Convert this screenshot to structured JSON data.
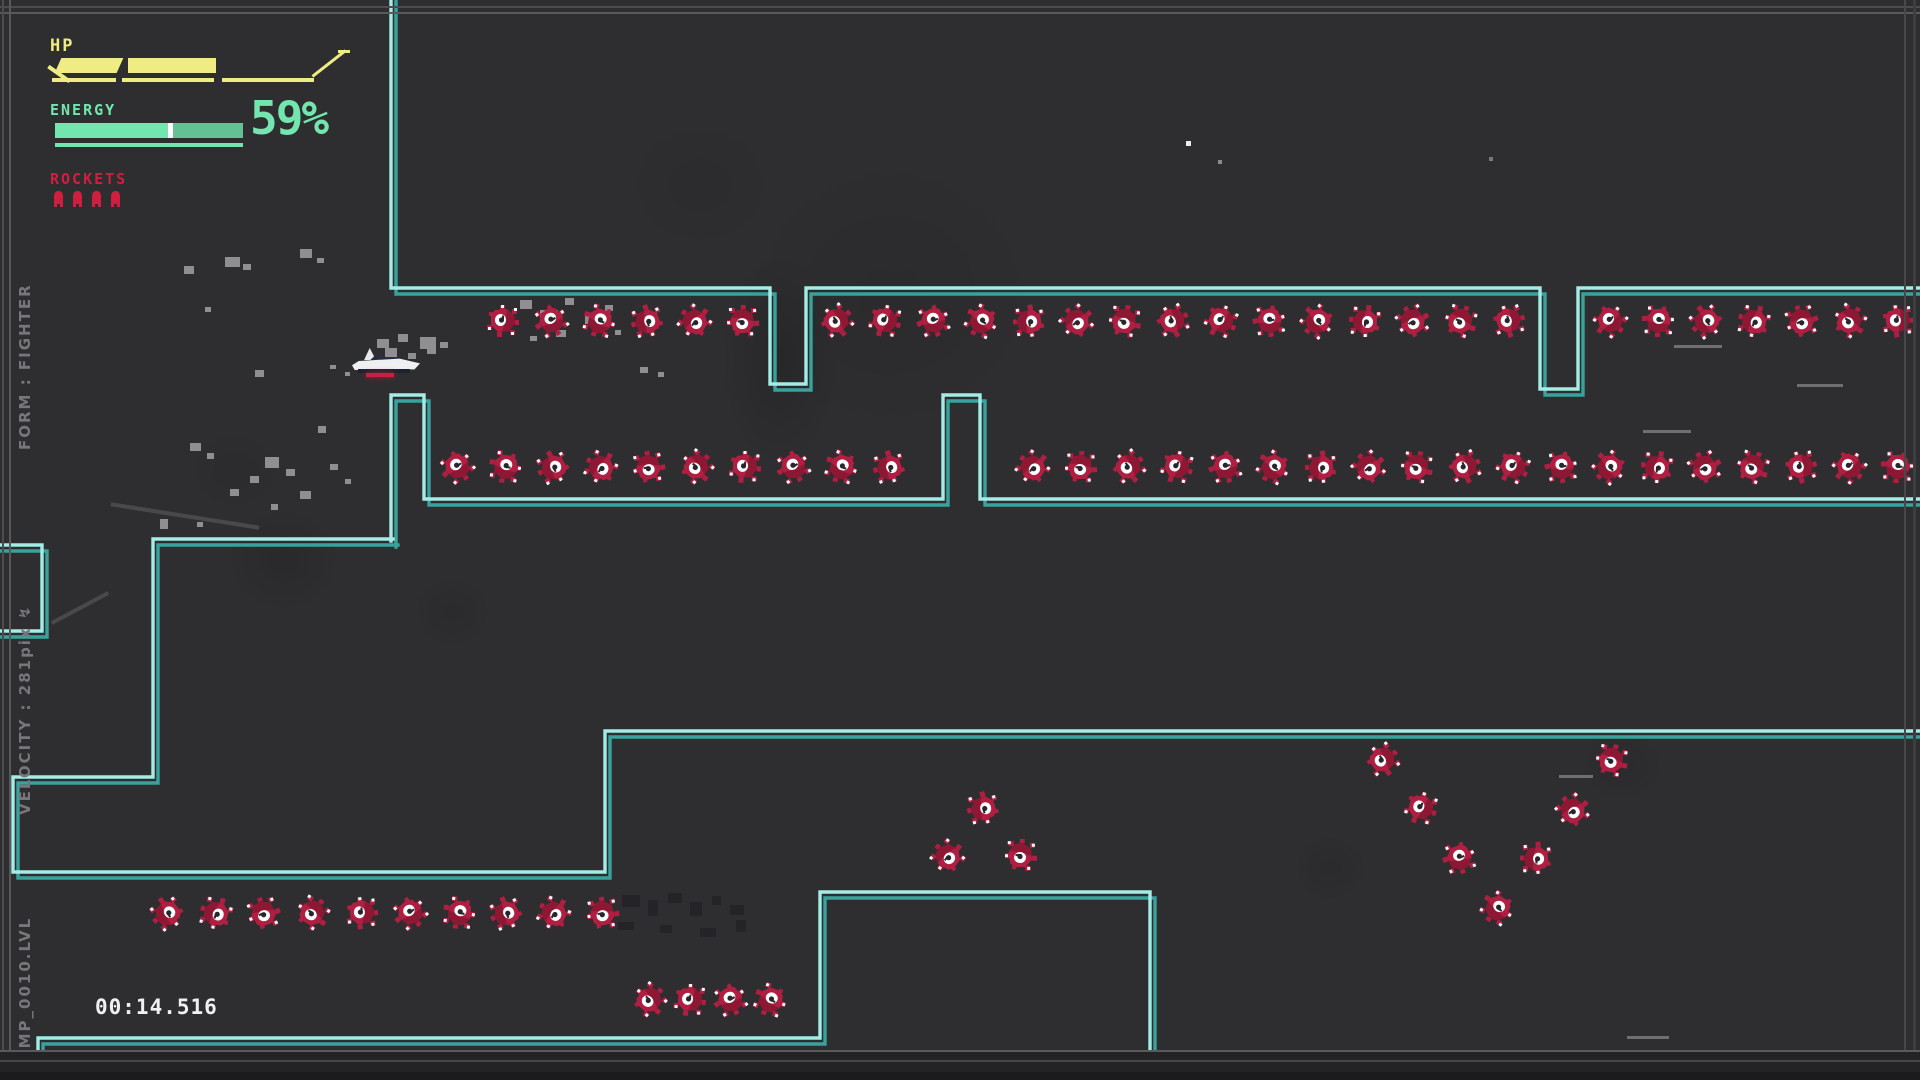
{
  "hud": {
    "hp_label": "HP",
    "energy_label": "ENERGY",
    "energy_percent": "59%",
    "rockets_label": "ROCKETS",
    "rocket_count": 4
  },
  "side_info": {
    "level_file": "CAMP_0010.LVL",
    "velocity": "VELOCITY : 281pix ↯",
    "form": "FORM : FIGHTER"
  },
  "timer": "00:14.516",
  "colors": {
    "background": "#2e2e30",
    "wall_bright": "#a4ece6",
    "wall_dark": "#3aa29c",
    "hp_yellow": "#efec83",
    "energy_mint": "#72e6ae",
    "rocket_red": "#d01f3e",
    "mine_crimson": "#b01f42",
    "mine_shade": "#8e1834",
    "timer_white": "#f0f0f0",
    "side_text_gray": "#77777b"
  },
  "level": {
    "walls": [
      {
        "name": "top-corridor",
        "points": [
          [
            391,
            -6
          ],
          [
            391,
            288
          ],
          [
            770,
            288
          ],
          [
            770,
            384
          ],
          [
            806,
            384
          ],
          [
            806,
            288
          ],
          [
            1540,
            288
          ],
          [
            1540,
            389
          ],
          [
            1578,
            389
          ],
          [
            1578,
            288
          ],
          [
            1926,
            288
          ]
        ]
      },
      {
        "name": "second-wall",
        "points": [
          [
            391,
            541
          ],
          [
            391,
            395
          ],
          [
            424,
            395
          ],
          [
            424,
            499
          ],
          [
            943,
            499
          ],
          [
            943,
            395
          ],
          [
            980,
            395
          ],
          [
            980,
            499
          ],
          [
            1926,
            499
          ]
        ]
      },
      {
        "name": "staircase",
        "points": [
          [
            393,
            539
          ],
          [
            153,
            539
          ],
          [
            153,
            777
          ],
          [
            13,
            777
          ],
          [
            13,
            872
          ],
          [
            605,
            872
          ],
          [
            605,
            731
          ],
          [
            1926,
            731
          ]
        ]
      },
      {
        "name": "bottom-step",
        "points": [
          [
            38,
            1086
          ],
          [
            38,
            1038
          ],
          [
            820,
            1038
          ],
          [
            820,
            892
          ],
          [
            1150,
            892
          ],
          [
            1150,
            1086
          ]
        ]
      },
      {
        "name": "left-box",
        "points": [
          [
            -6,
            545
          ],
          [
            42,
            545
          ],
          [
            42,
            631
          ],
          [
            -6,
            631
          ]
        ]
      }
    ],
    "mines": [
      [
        503,
        321
      ],
      [
        551,
        321
      ],
      [
        599,
        321
      ],
      [
        647,
        321
      ],
      [
        695,
        321
      ],
      [
        743,
        321
      ],
      [
        837,
        321
      ],
      [
        885,
        321
      ],
      [
        933,
        321
      ],
      [
        981,
        321
      ],
      [
        1029,
        321
      ],
      [
        1077,
        321
      ],
      [
        1125,
        321
      ],
      [
        1173,
        321
      ],
      [
        1221,
        321
      ],
      [
        1269,
        321
      ],
      [
        1317,
        321
      ],
      [
        1365,
        321
      ],
      [
        1413,
        321
      ],
      [
        1461,
        321
      ],
      [
        1509,
        321
      ],
      [
        1610,
        321
      ],
      [
        1658,
        321
      ],
      [
        1706,
        321
      ],
      [
        1754,
        321
      ],
      [
        1802,
        321
      ],
      [
        1850,
        321
      ],
      [
        1898,
        321
      ],
      [
        457,
        467
      ],
      [
        505,
        467
      ],
      [
        553,
        467
      ],
      [
        601,
        467
      ],
      [
        649,
        467
      ],
      [
        697,
        467
      ],
      [
        745,
        467
      ],
      [
        793,
        467
      ],
      [
        841,
        467
      ],
      [
        889,
        467
      ],
      [
        1033,
        467
      ],
      [
        1081,
        467
      ],
      [
        1129,
        467
      ],
      [
        1177,
        467
      ],
      [
        1225,
        467
      ],
      [
        1273,
        467
      ],
      [
        1321,
        467
      ],
      [
        1369,
        467
      ],
      [
        1417,
        467
      ],
      [
        1465,
        467
      ],
      [
        1513,
        467
      ],
      [
        1561,
        467
      ],
      [
        1609,
        467
      ],
      [
        1657,
        467
      ],
      [
        1705,
        467
      ],
      [
        1753,
        467
      ],
      [
        1801,
        467
      ],
      [
        1849,
        467
      ],
      [
        1897,
        467
      ],
      [
        167,
        913
      ],
      [
        216,
        913
      ],
      [
        264,
        913
      ],
      [
        313,
        913
      ],
      [
        362,
        913
      ],
      [
        410,
        913
      ],
      [
        459,
        913
      ],
      [
        506,
        913
      ],
      [
        554,
        913
      ],
      [
        603,
        913
      ],
      [
        650,
        1000
      ],
      [
        690,
        1000
      ],
      [
        730,
        1000
      ],
      [
        770,
        1000
      ],
      [
        983,
        808
      ],
      [
        948,
        856
      ],
      [
        1021,
        855
      ],
      [
        1383,
        760
      ],
      [
        1421,
        808
      ],
      [
        1459,
        858
      ],
      [
        1497,
        908
      ],
      [
        1536,
        858
      ],
      [
        1573,
        810
      ],
      [
        1612,
        760
      ]
    ],
    "debris": [
      [
        184,
        266,
        10,
        8
      ],
      [
        225,
        257,
        15,
        10
      ],
      [
        243,
        264,
        8,
        6
      ],
      [
        300,
        249,
        12,
        9
      ],
      [
        317,
        258,
        7,
        5
      ],
      [
        205,
        307,
        6,
        5
      ],
      [
        255,
        370,
        9,
        7
      ],
      [
        318,
        426,
        8,
        7
      ],
      [
        190,
        443,
        11,
        8
      ],
      [
        207,
        453,
        7,
        6
      ],
      [
        250,
        476,
        9,
        7
      ],
      [
        160,
        519,
        8,
        10
      ],
      [
        197,
        522,
        6,
        5
      ],
      [
        377,
        339,
        12,
        9
      ],
      [
        398,
        334,
        10,
        8
      ],
      [
        420,
        337,
        16,
        12
      ],
      [
        440,
        342,
        8,
        6
      ],
      [
        385,
        348,
        12,
        9
      ],
      [
        408,
        353,
        8,
        6
      ],
      [
        427,
        347,
        9,
        7
      ],
      [
        520,
        300,
        12,
        9
      ],
      [
        540,
        310,
        18,
        12
      ],
      [
        565,
        298,
        9,
        7
      ],
      [
        585,
        315,
        12,
        9
      ],
      [
        605,
        305,
        8,
        6
      ],
      [
        556,
        330,
        10,
        7
      ],
      [
        530,
        336,
        7,
        5
      ],
      [
        615,
        330,
        6,
        5
      ],
      [
        640,
        367,
        8,
        6
      ],
      [
        658,
        372,
        6,
        5
      ],
      [
        265,
        457,
        14,
        11
      ],
      [
        286,
        469,
        9,
        7
      ],
      [
        300,
        491,
        11,
        8
      ],
      [
        271,
        504,
        7,
        6
      ],
      [
        330,
        464,
        8,
        6
      ],
      [
        345,
        479,
        6,
        5
      ],
      [
        230,
        489,
        9,
        7
      ],
      [
        330,
        365,
        6,
        4
      ],
      [
        345,
        372,
        5,
        4
      ]
    ],
    "ghost_debris": [
      [
        622,
        895,
        18,
        12
      ],
      [
        648,
        900,
        10,
        16
      ],
      [
        668,
        893,
        14,
        10
      ],
      [
        690,
        902,
        12,
        14
      ],
      [
        712,
        896,
        9,
        9
      ],
      [
        730,
        905,
        14,
        10
      ],
      [
        618,
        922,
        16,
        8
      ],
      [
        660,
        925,
        12,
        8
      ],
      [
        700,
        928,
        16,
        9
      ],
      [
        736,
        920,
        10,
        12
      ]
    ],
    "dashes": [
      [
        1674,
        345,
        48
      ],
      [
        1797,
        384,
        46
      ],
      [
        1643,
        430,
        48
      ],
      [
        1559,
        775,
        34
      ],
      [
        1627,
        1036,
        42
      ]
    ],
    "particles": [
      [
        1186,
        141,
        5,
        "#ececec"
      ],
      [
        1218,
        160,
        4,
        "#8a8a8a"
      ],
      [
        1489,
        157,
        4,
        "#7a7a7a"
      ]
    ],
    "vignettes": [
      [
        890,
        295,
        160,
        150,
        0.07
      ],
      [
        283,
        560,
        60,
        55,
        0.1
      ],
      [
        452,
        612,
        42,
        38,
        0.08
      ],
      [
        1622,
        765,
        44,
        40,
        0.08
      ],
      [
        1330,
        868,
        40,
        36,
        0.08
      ],
      [
        779,
        360,
        60,
        110,
        0.14
      ],
      [
        700,
        185,
        85,
        75,
        0.05
      ],
      [
        235,
        470,
        50,
        45,
        0.06
      ]
    ],
    "streaks": [
      [
        48,
        606,
        64,
        -28
      ],
      [
        110,
        514,
        150,
        9
      ]
    ]
  },
  "player": {
    "x": 352,
    "y": 346
  }
}
